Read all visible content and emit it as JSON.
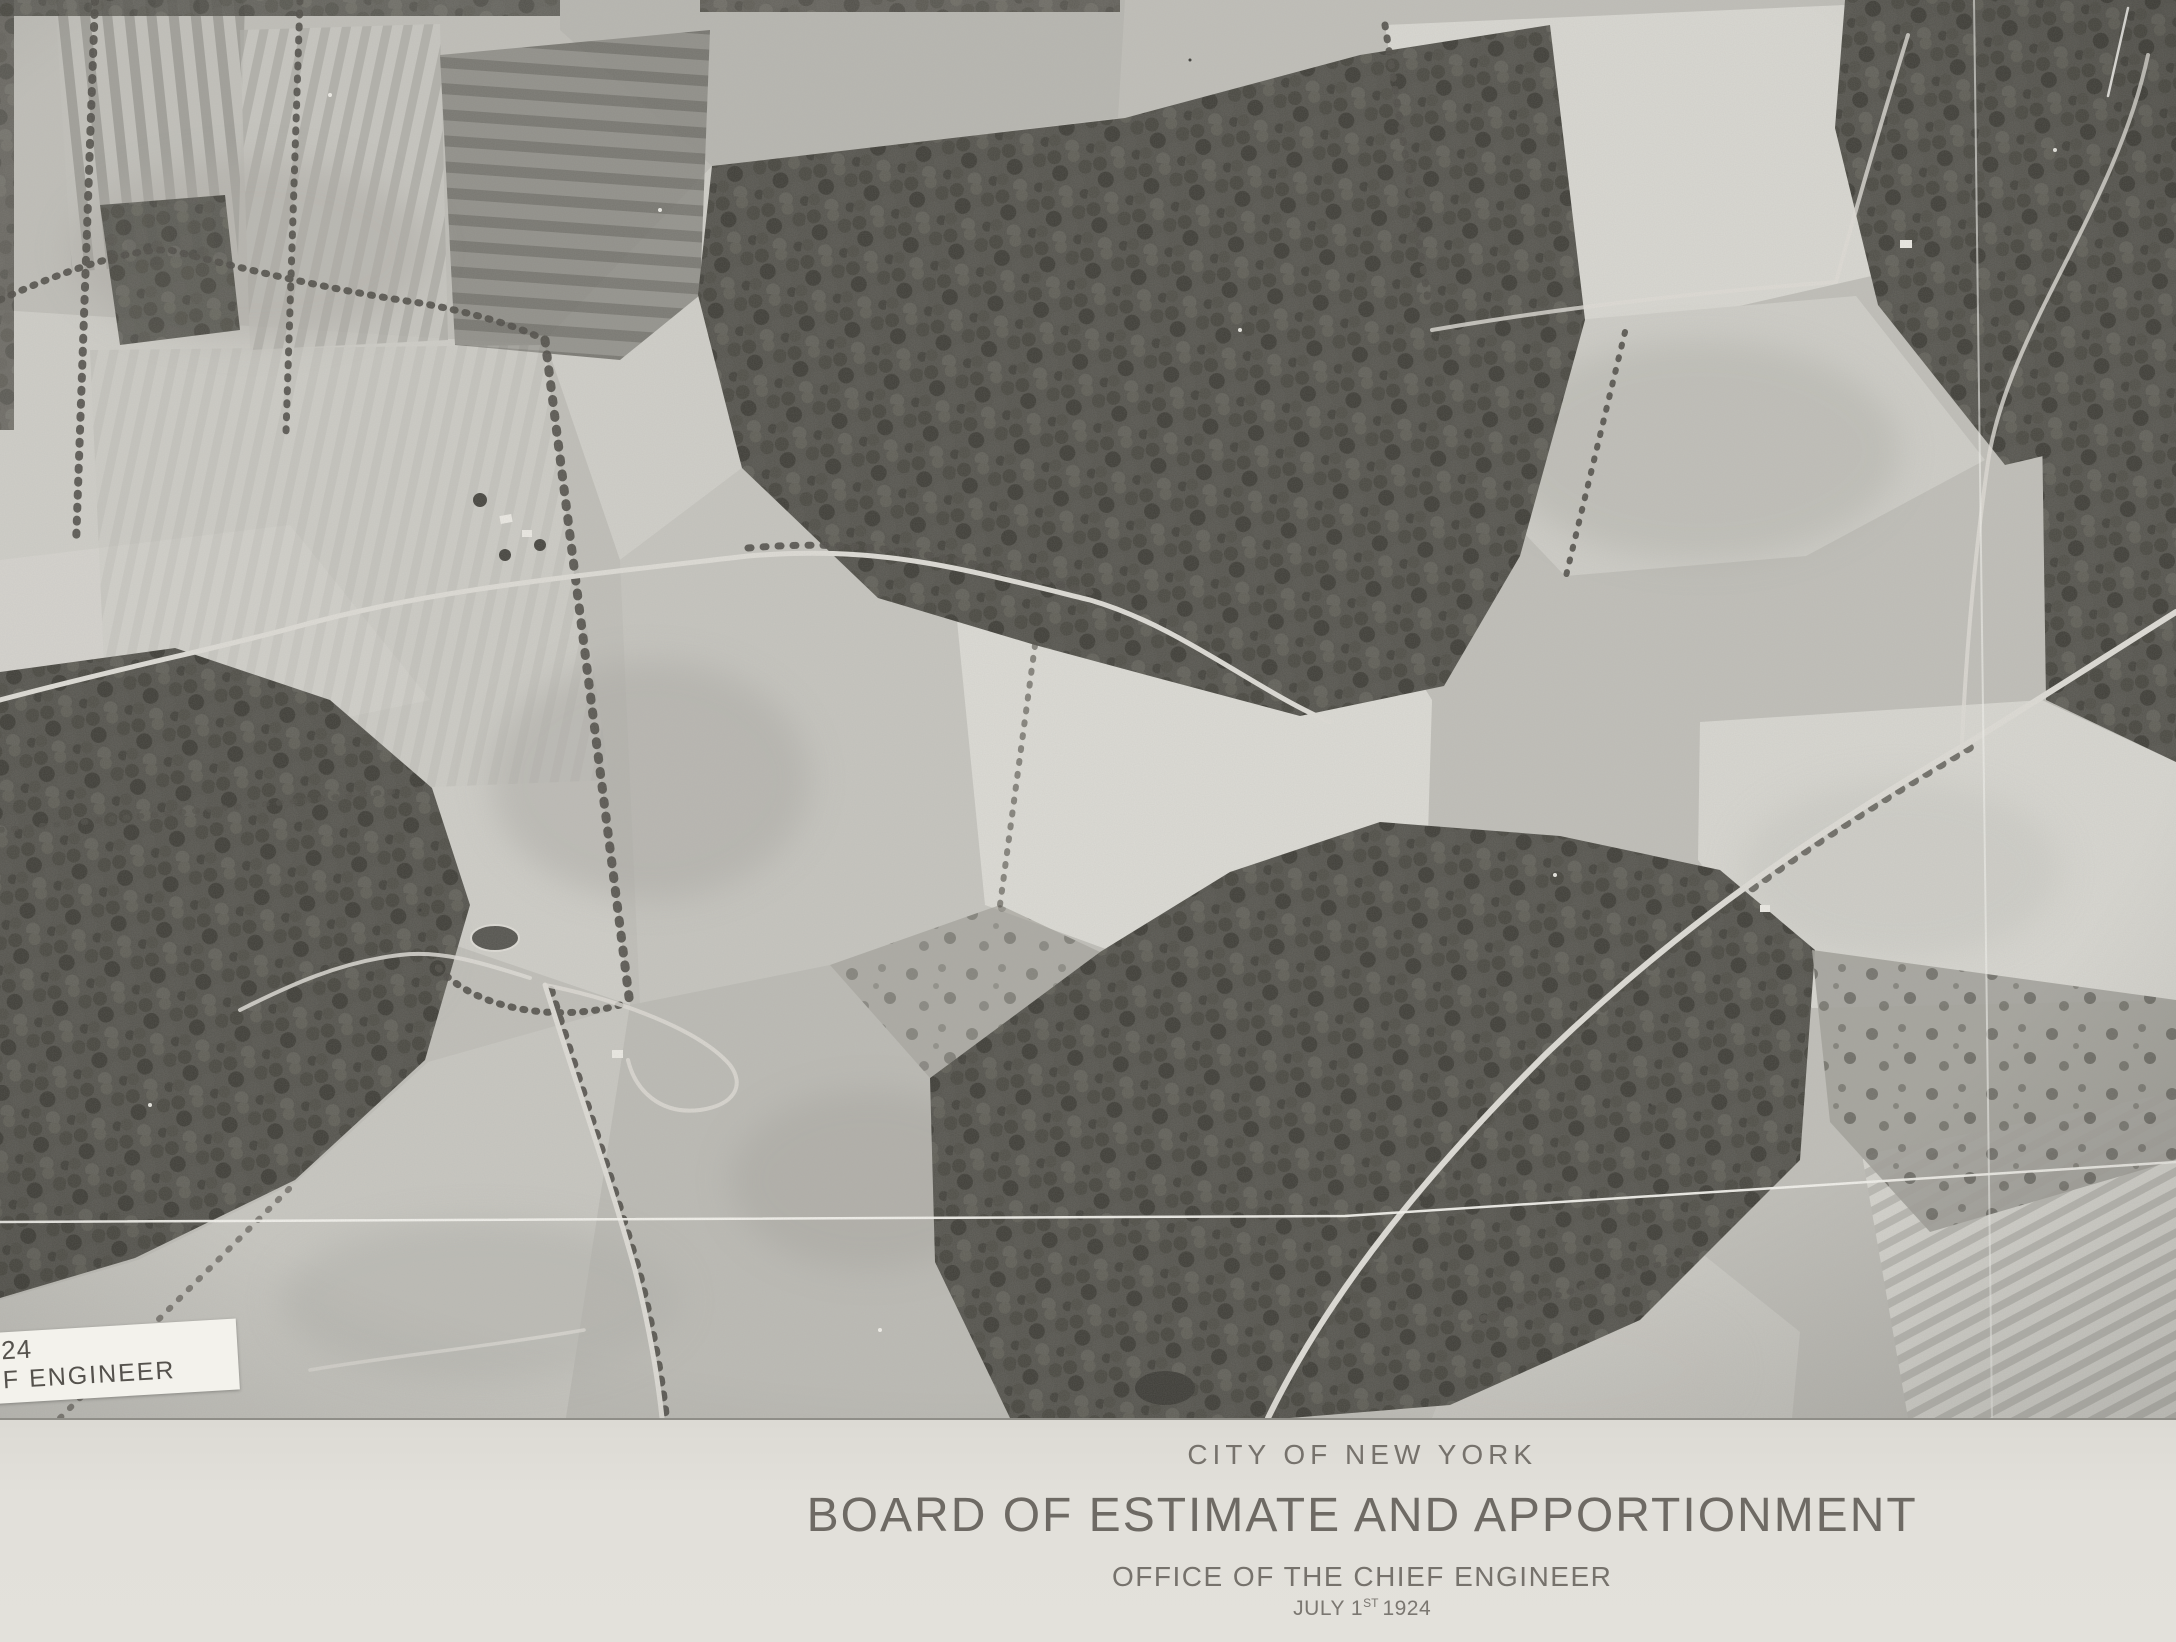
{
  "caption": {
    "city": "CITY OF NEW YORK",
    "board": "BOARD OF ESTIMATE AND APPORTIONMENT",
    "office": "OFFICE OF THE CHIEF ENGINEER",
    "date": {
      "prefix": "JULY 1",
      "superscript": "ST",
      "suffix": "1924"
    }
  },
  "photo_label": {
    "line1": "24",
    "line2": "F ENGINEER"
  },
  "colors": {
    "caption_paper": "#e0ded8",
    "caption_text": "#76726c",
    "photo_base": "#c0bfb9",
    "bright_field": "#e6e5df",
    "forest_dark": "#55544e",
    "scratch_white": "#f4f3ee",
    "label_paper": "#f3f2ec",
    "label_text": "#55524d"
  }
}
